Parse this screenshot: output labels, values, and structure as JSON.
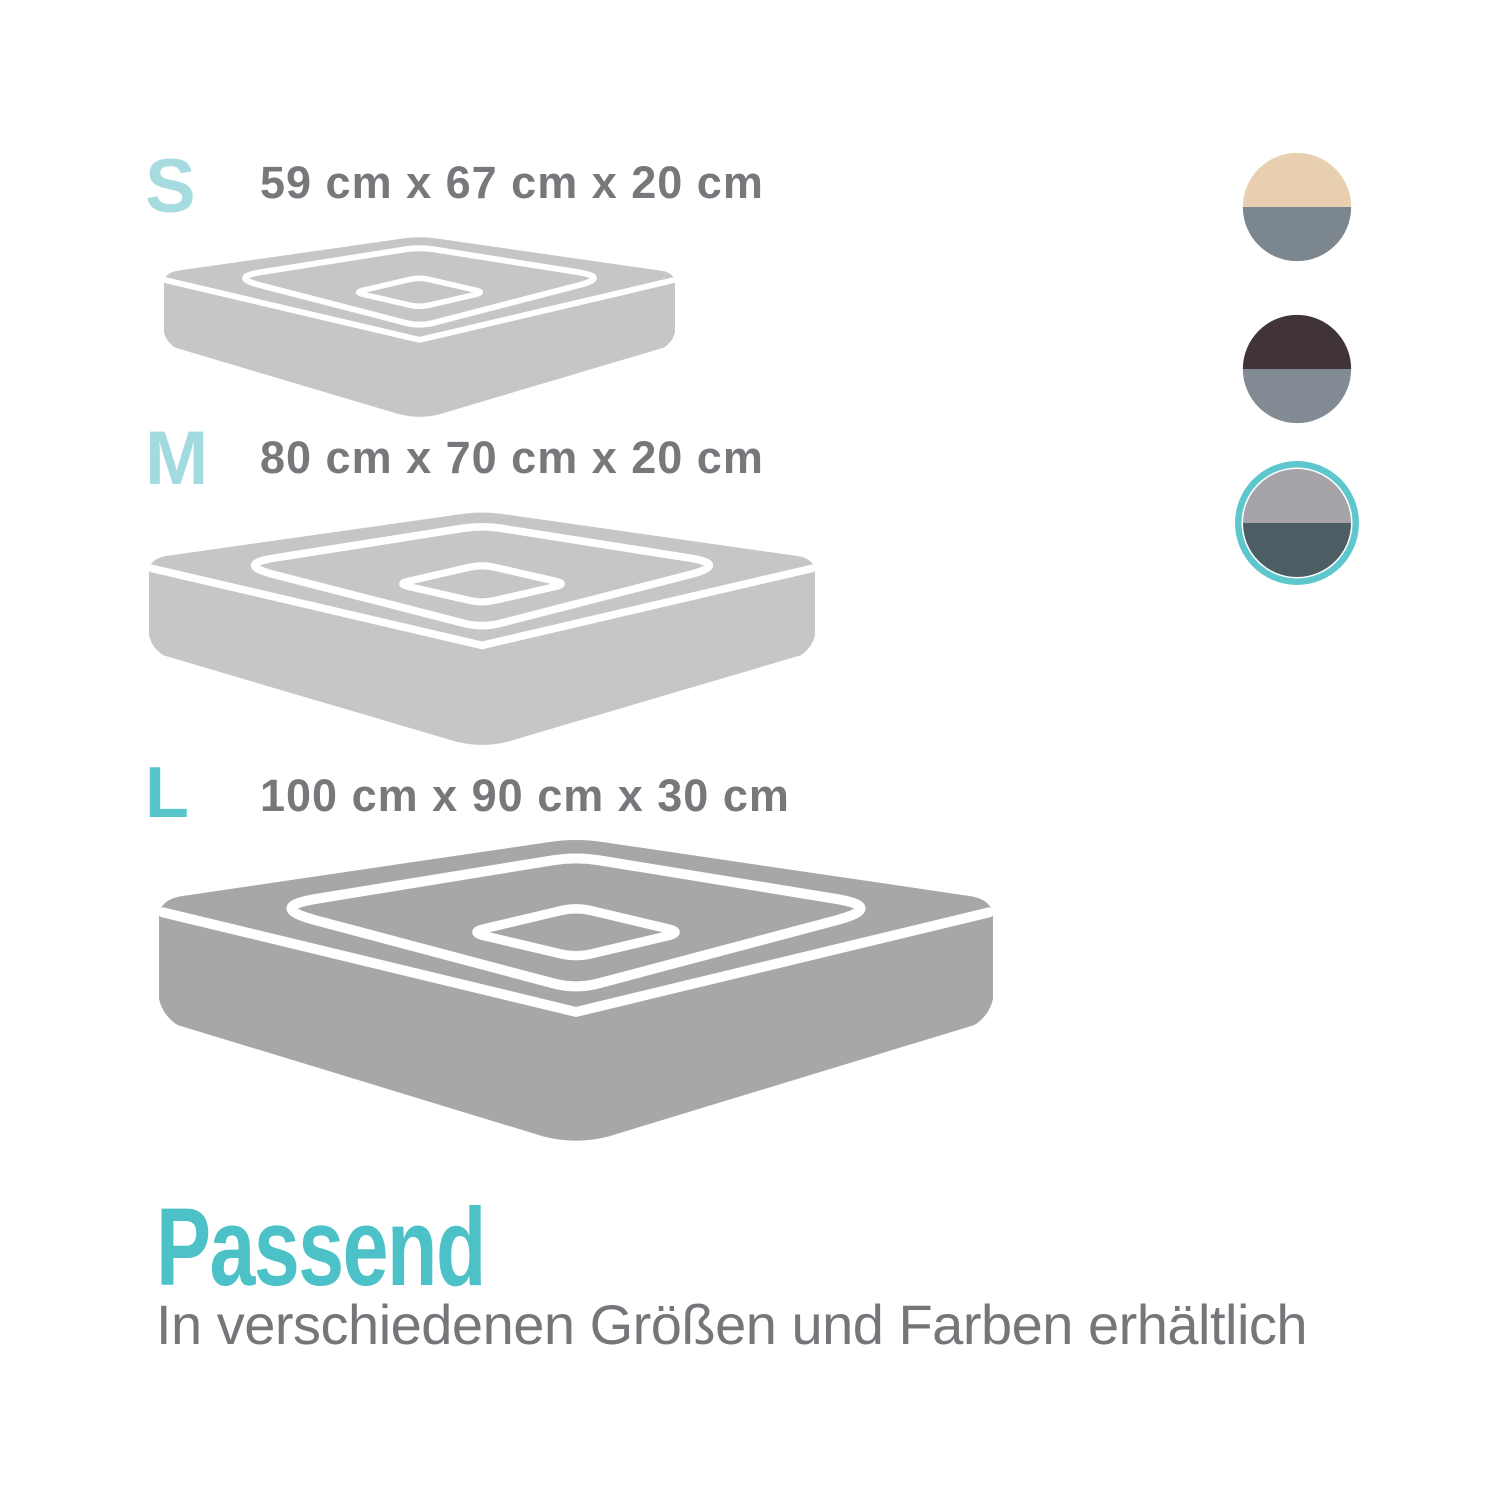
{
  "page": {
    "background": "#ffffff"
  },
  "text_color": "#77787b",
  "sizes": [
    {
      "label": "S",
      "label_color": "#a6dce0",
      "dimensions": "59 cm x 67 cm x 20 cm",
      "bed_color": "#c6c6c7"
    },
    {
      "label": "M",
      "label_color": "#a2dbdf",
      "dimensions": "80 cm x 70 cm x 20 cm",
      "bed_color": "#c6c6c7"
    },
    {
      "label": "L",
      "label_color": "#58c5cb",
      "dimensions": "100 cm x 90 cm x 30 cm",
      "bed_color": "#a7a7a8"
    }
  ],
  "swatches": [
    {
      "name": "beige-gray",
      "top": "#e7cfb0",
      "bottom": "#7b868e",
      "selected": false
    },
    {
      "name": "darkbrown-gray",
      "top": "#403339",
      "bottom": "#828b93",
      "selected": false
    },
    {
      "name": "lightgray-slate",
      "top": "#a6a4a9",
      "bottom": "#4c5d64",
      "selected": true,
      "ring_color": "#5ec7cd"
    }
  ],
  "footer": {
    "title": "Passend",
    "title_color": "#4cc1c8",
    "subtitle": "In verschiedenen Größen und Farben erhältlich",
    "subtitle_color": "#75767a"
  }
}
